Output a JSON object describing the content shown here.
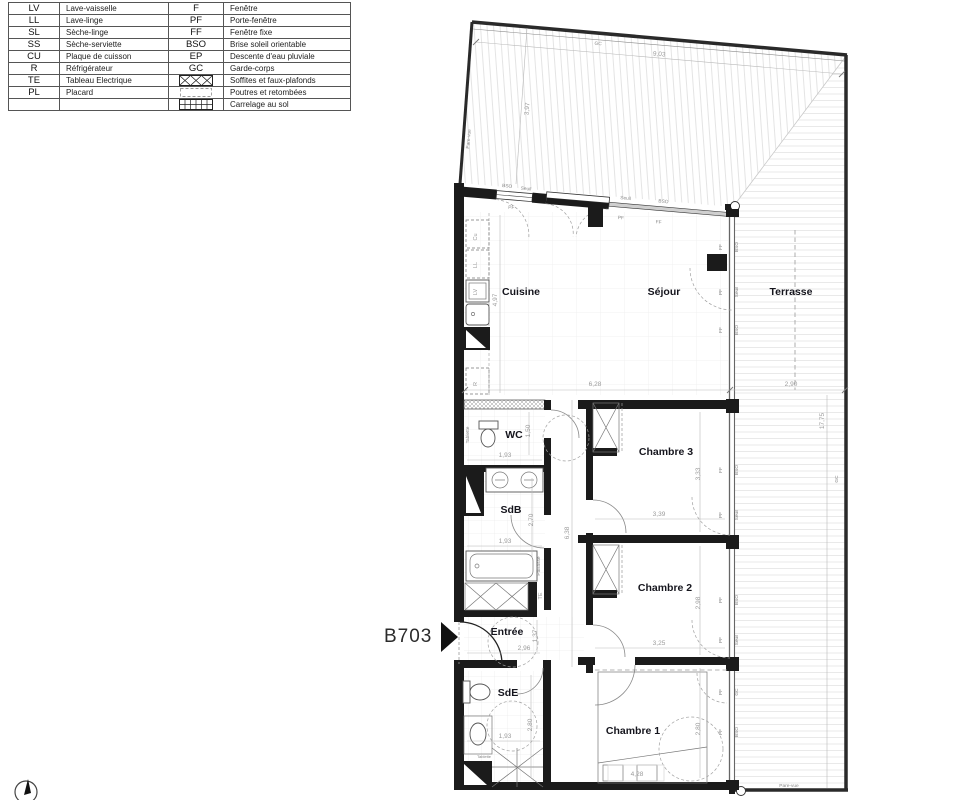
{
  "legend": {
    "rows": [
      {
        "a1": "LV",
        "l1": "Lave-vaisselle",
        "a2": "F",
        "l2": "Fenêtre"
      },
      {
        "a1": "LL",
        "l1": "Lave-linge",
        "a2": "PF",
        "l2": "Porte-fenêtre"
      },
      {
        "a1": "SL",
        "l1": "Sèche-linge",
        "a2": "FF",
        "l2": "Fenêtre fixe"
      },
      {
        "a1": "SS",
        "l1": "Sèche-serviette",
        "a2": "BSO",
        "l2": "Brise soleil orientable"
      },
      {
        "a1": "CU",
        "l1": "Plaque de cuisson",
        "a2": "EP",
        "l2": "Descente d'eau pluviale"
      },
      {
        "a1": "R",
        "l1": "Réfrigérateur",
        "a2": "GC",
        "l2": "Garde-corps"
      },
      {
        "a1": "TE",
        "l1": "Tableau Electrique",
        "a2": "",
        "l2": "Soffites et faux-plafonds"
      },
      {
        "a1": "PL",
        "l1": "Placard",
        "a2": "",
        "l2": "Poutres et retombées"
      },
      {
        "a1": "",
        "l1": "",
        "a2": "",
        "l2": "Carrelage au sol"
      }
    ]
  },
  "plan": {
    "unit": "B703",
    "rooms": {
      "cuisine": "Cuisine",
      "sejour": "Séjour",
      "terrasse": "Terrasse",
      "wc": "WC",
      "sdb": "SdB",
      "chambre3": "Chambre 3",
      "chambre2": "Chambre 2",
      "entree": "Entrée",
      "sde": "SdE",
      "chambre1": "Chambre 1"
    },
    "dims": {
      "terrasse_top_w": "9,03",
      "terrasse_top_d": "3,97",
      "terrasse_side_h": "17,75",
      "cuisine_d": "4,97",
      "sejour_w": "6,28",
      "terrasse_w": "2,90",
      "wc_d": "1,50",
      "wc_w": "1,93",
      "sdb_d": "2,70",
      "sdb_w": "1,93",
      "couloir_h": "6,38",
      "ch3_d": "3,33",
      "ch3_w": "3,39",
      "ch2_d": "2,98",
      "ch2_w": "3,25",
      "entree_w": "2,96",
      "entree_d": "1,37",
      "sde_w": "1,93",
      "sde_d": "2,80",
      "ch1_w": "4,28",
      "ch1_d": "2,80"
    },
    "annotations": {
      "gc": "GC",
      "pare_vue": "Pare-vue",
      "bso": "BSO",
      "seuil": "Seuil",
      "pf": "PF",
      "ff": "FF",
      "cu": "Cu",
      "ll": "LL",
      "lv": "LV",
      "r": "R",
      "te": "TE",
      "tablette": "Tablette",
      "paillasse": "Paillasse"
    }
  }
}
